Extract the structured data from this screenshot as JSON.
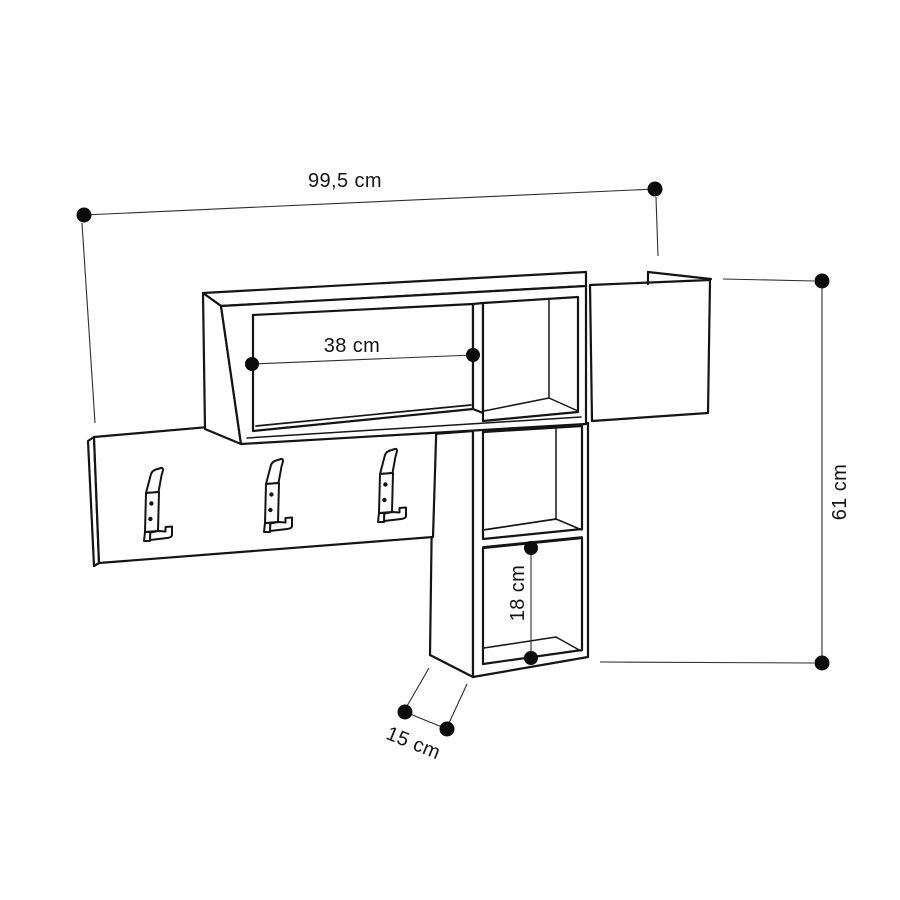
{
  "diagram": {
    "kind": "furniture-dimension-drawing",
    "unit": "cm",
    "colors": {
      "background": "#ffffff",
      "outline": "#141414",
      "dimension_line": "#2e2e2e",
      "label_text": "#141414",
      "endpoint_dot": "#0b0b0b"
    },
    "dimensions": [
      {
        "id": "overall-width",
        "label": "99,5 cm"
      },
      {
        "id": "shelf-opening",
        "label": "38 cm"
      },
      {
        "id": "overall-height",
        "label": "61 cm"
      },
      {
        "id": "cubby-height",
        "label": "18 cm"
      },
      {
        "id": "depth",
        "label": "15 cm"
      }
    ]
  }
}
